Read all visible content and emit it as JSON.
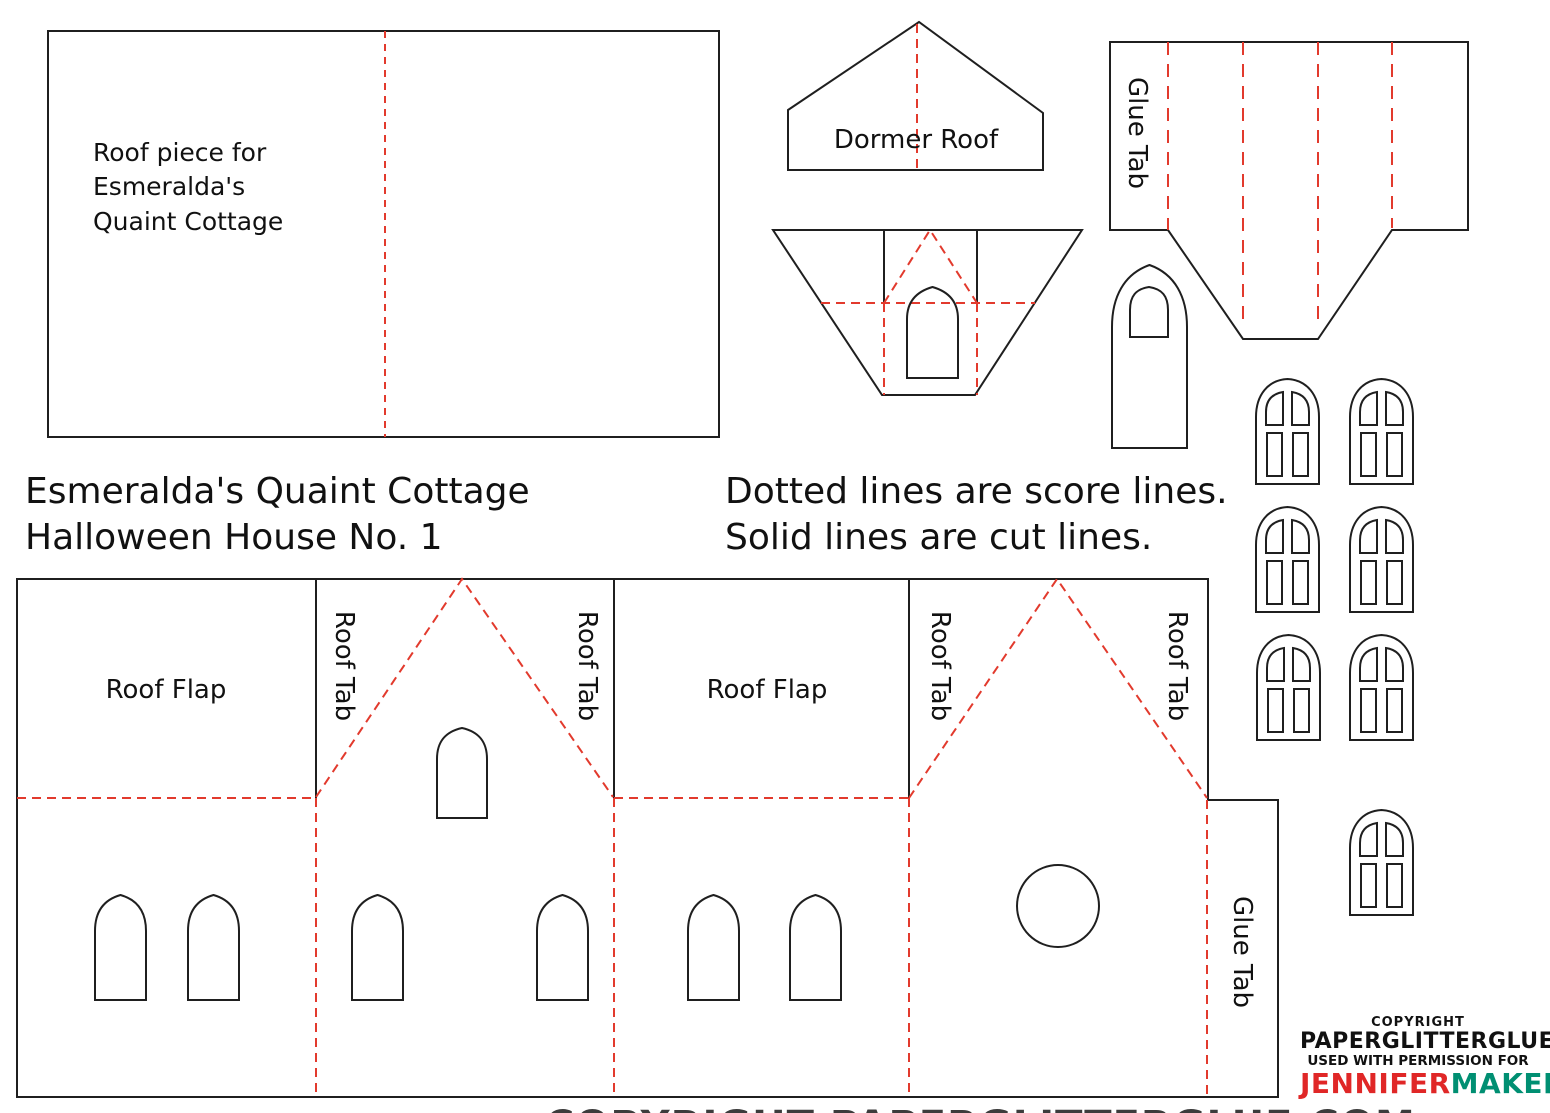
{
  "page": {
    "width": 1550,
    "height": 1113
  },
  "colors": {
    "background": "#ffffff",
    "cut_line": "#1f1f1f",
    "score_line": "#e23a2d",
    "label_text": "#111111",
    "copyright_text": "#111111",
    "brand_red": "#e02727",
    "brand_teal": "#008f72",
    "cutoff_text": "#3c3c3c"
  },
  "title": {
    "line1": "Esmeralda's Quaint Cottage",
    "line2": "Halloween House No. 1"
  },
  "legend": {
    "line1": "Dotted lines are score lines.",
    "line2": "Solid lines are cut lines."
  },
  "roof_piece": {
    "line1": "Roof piece for",
    "line2": "Esmeralda's",
    "line3": "Quaint Cottage"
  },
  "piece_labels": {
    "dormer_roof": "Dormer Roof",
    "glue_tab": "Glue Tab",
    "roof_flap": "Roof Flap",
    "roof_tab": "Roof Tab"
  },
  "copyright": {
    "line1": "COPYRIGHT",
    "line2": "PAPERGLITTERGLUE",
    "line3": "USED WITH PERMISSION FOR",
    "name_red": "JENNIFER",
    "name_teal": "MAKER"
  },
  "bottom_cutoff_text": "COPYRIGHT PAPERGLITTERGLUE.COM"
}
